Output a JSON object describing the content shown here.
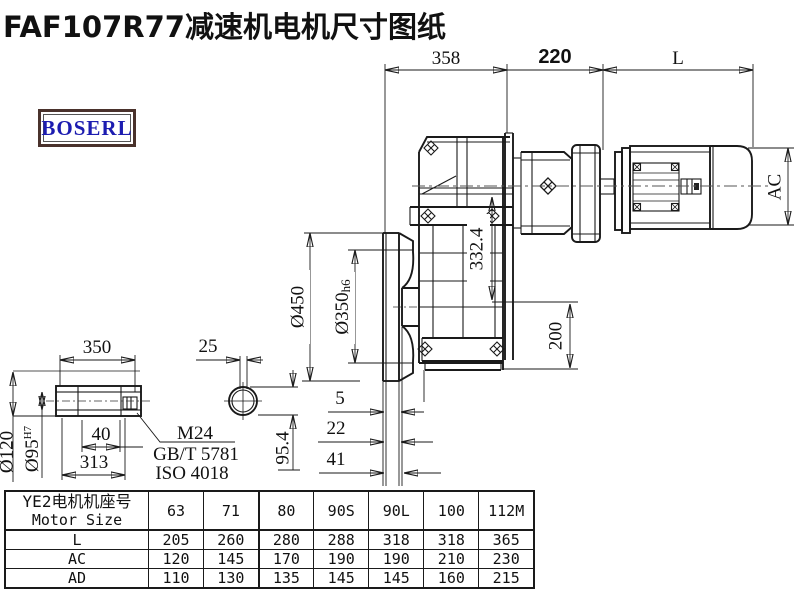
{
  "title": "FAF107R77减速机电机尺寸图纸",
  "logo": {
    "text": "BOSERL"
  },
  "drawing": {
    "top_dims": {
      "w358": "358",
      "w220": "220",
      "L": "L"
    },
    "right_dims": {
      "AC": "AC"
    },
    "flange_dims": {
      "d450": "Ø450",
      "d350": "Ø350",
      "d350_tol": "h6"
    },
    "mid_dims": {
      "h3324": "332.4",
      "h200": "200"
    },
    "offset_dims": {
      "o5": "5",
      "o22": "22",
      "o41": "41"
    },
    "shaft": {
      "len350": "350",
      "w25": "25",
      "l40": "40",
      "l313": "313",
      "d120": "Ø120",
      "d95": "Ø95",
      "d95_tol": "H7",
      "h954": "95.4",
      "thread": "M24",
      "std1": "GB/T 5781",
      "std2": "ISO 4018"
    }
  },
  "table": {
    "header_cn": "YE2电机机座号",
    "header_en": "Motor Size",
    "columns": [
      "63",
      "71",
      "80",
      "90S",
      "90L",
      "100",
      "112M"
    ],
    "rows": [
      {
        "label": "L",
        "values": [
          "205",
          "260",
          "280",
          "288",
          "318",
          "318",
          "365"
        ]
      },
      {
        "label": "AC",
        "values": [
          "120",
          "145",
          "170",
          "190",
          "190",
          "210",
          "230"
        ]
      },
      {
        "label": "AD",
        "values": [
          "110",
          "130",
          "135",
          "145",
          "145",
          "160",
          "215"
        ]
      }
    ]
  }
}
